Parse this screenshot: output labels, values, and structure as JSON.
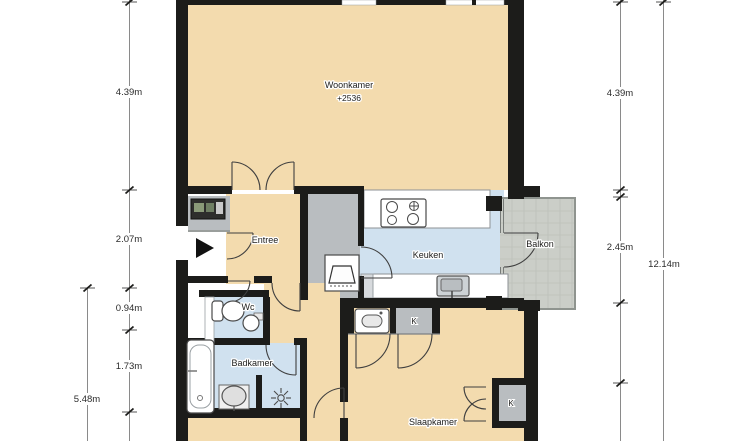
{
  "plan": {
    "type": "apartment-floor-plan",
    "rooms": {
      "woonkamer": {
        "label": "Woonkamer",
        "level": "+2536"
      },
      "entree": {
        "label": "Entree"
      },
      "keuken": {
        "label": "Keuken"
      },
      "balkon": {
        "label": "Balkon"
      },
      "wc": {
        "label": "Wc"
      },
      "badkamer": {
        "label": "Badkamer"
      },
      "slaapkamer": {
        "label": "Slaapkamer"
      }
    },
    "closets": {
      "kitchen_closet": "K",
      "bedroom_closet": "K"
    },
    "dimensions": {
      "left": {
        "segments": [
          "4.39m",
          "2.07m",
          "0.94m",
          "1.73m"
        ],
        "partial_total": "5.48m"
      },
      "right": {
        "segments": [
          "4.39m",
          "2.45m"
        ],
        "total": "12.14m"
      }
    },
    "icons": [
      "stove-icon",
      "kitchen-sink-icon",
      "washing-machine-icon",
      "meter-cabinet-icon",
      "closet-fixture-icon",
      "toilet-icon",
      "hand-basin-icon",
      "bathtub-icon",
      "bathroom-sink-icon",
      "shower-icon",
      "entrance-arrow-icon"
    ],
    "colors": {
      "wall": "#1c1c1a",
      "floor_main": "#f3dbae",
      "floor_wet": "#d0e1ef",
      "floor_closet": "#b9bdc0",
      "floor_balcony": "#cbcec8",
      "background": "#ffffff"
    }
  }
}
